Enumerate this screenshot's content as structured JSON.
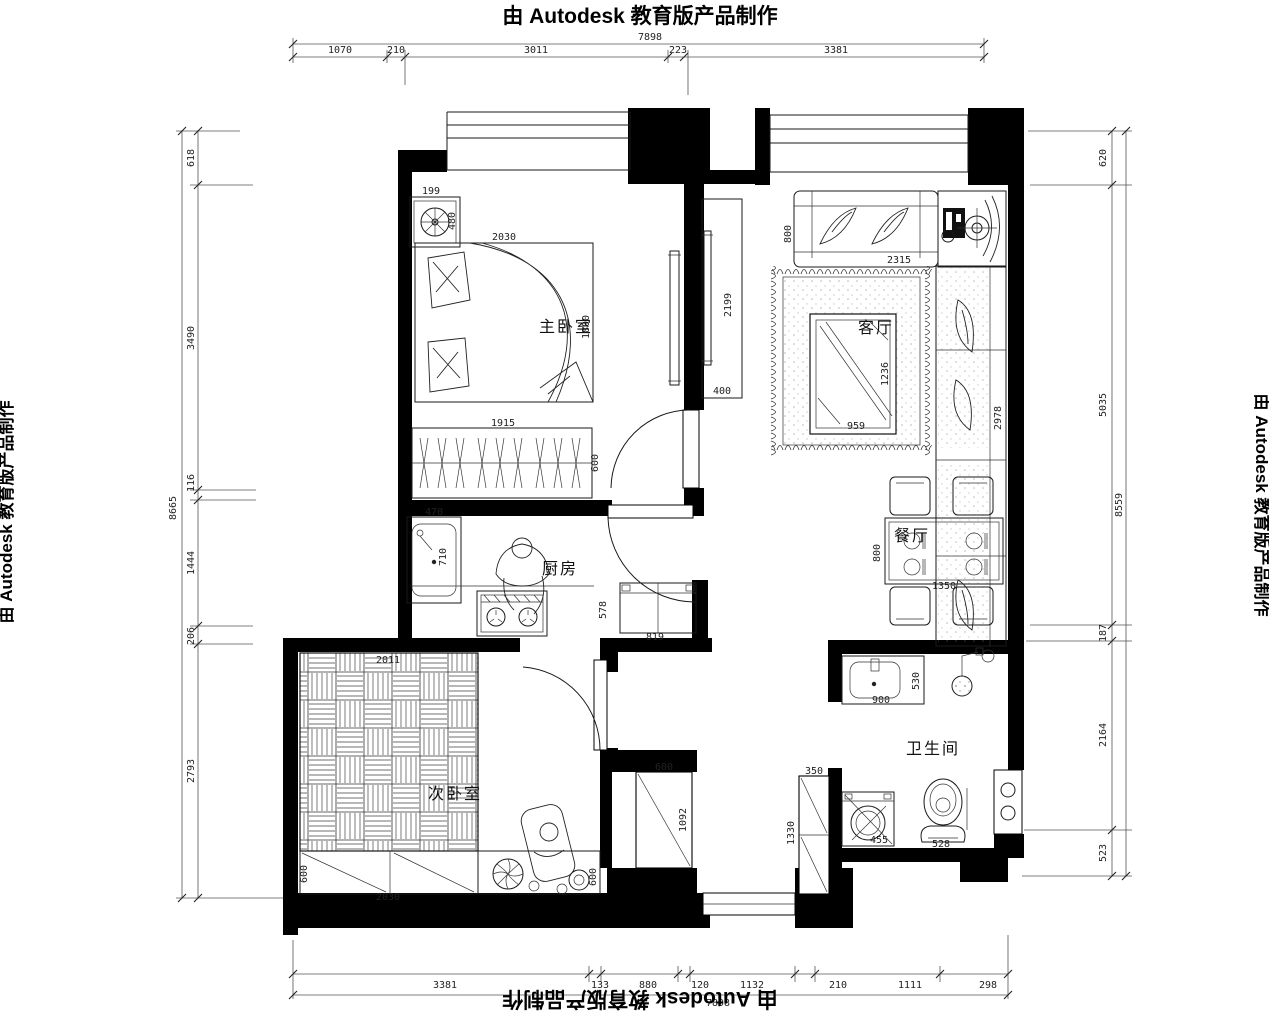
{
  "watermarks": {
    "top": "由 Autodesk 教育版产品制作",
    "bottom": "由 Autodesk 教育版产品制作",
    "left": "由 Autodesk 教育版产品制作",
    "right": "由 Autodesk 教育版产品制作"
  },
  "rooms": {
    "master_bedroom": "主卧室",
    "living_room": "客厅",
    "kitchen": "厨房",
    "dining_room": "餐厅",
    "bathroom": "卫生间",
    "second_bedroom": "次卧室"
  },
  "dims": {
    "top": {
      "total": "7898",
      "segs": [
        "1070",
        "210",
        "3011",
        "223",
        "3381"
      ]
    },
    "bottom": {
      "total": "7898",
      "segs": [
        "3381",
        "133",
        "880",
        "120",
        "1132",
        "210",
        "1111",
        "298"
      ]
    },
    "left": {
      "total": "8665",
      "segs": [
        "618",
        "3490",
        "116",
        "1444",
        "206",
        "2793"
      ]
    },
    "right": {
      "total": "8559",
      "segs": [
        "620",
        "5035",
        "187",
        "2164",
        "523"
      ]
    }
  },
  "furniture_dims": {
    "planter_w": "199",
    "planter_h": "480",
    "bed_w": "2030",
    "bed_l": "1800",
    "wardrobe_w": "1915",
    "wardrobe_d": "600",
    "tv_wall_l": "2199",
    "tv_wall_w": "400",
    "sofa_d": "800",
    "sofa_w": "2315",
    "chaise_l": "2978",
    "coffee_table_l": "1236",
    "coffee_table_w": "959",
    "sink_w": "470",
    "sink_l": "710",
    "fridge_d": "578",
    "fridge_w": "819",
    "dining_table_d": "800",
    "dining_table_w": "1350",
    "vanity_w": "900",
    "vanity_d": "530",
    "toilet_w": "528",
    "washer_w": "455",
    "hall_closet_w": "600",
    "hall_closet_l": "1092",
    "hall_cabinet_w": "350",
    "hall_cabinet_l": "1330",
    "tatami_w": "2011",
    "drawers_d": "600",
    "drawers_w": "2030",
    "stool_d": "600"
  }
}
